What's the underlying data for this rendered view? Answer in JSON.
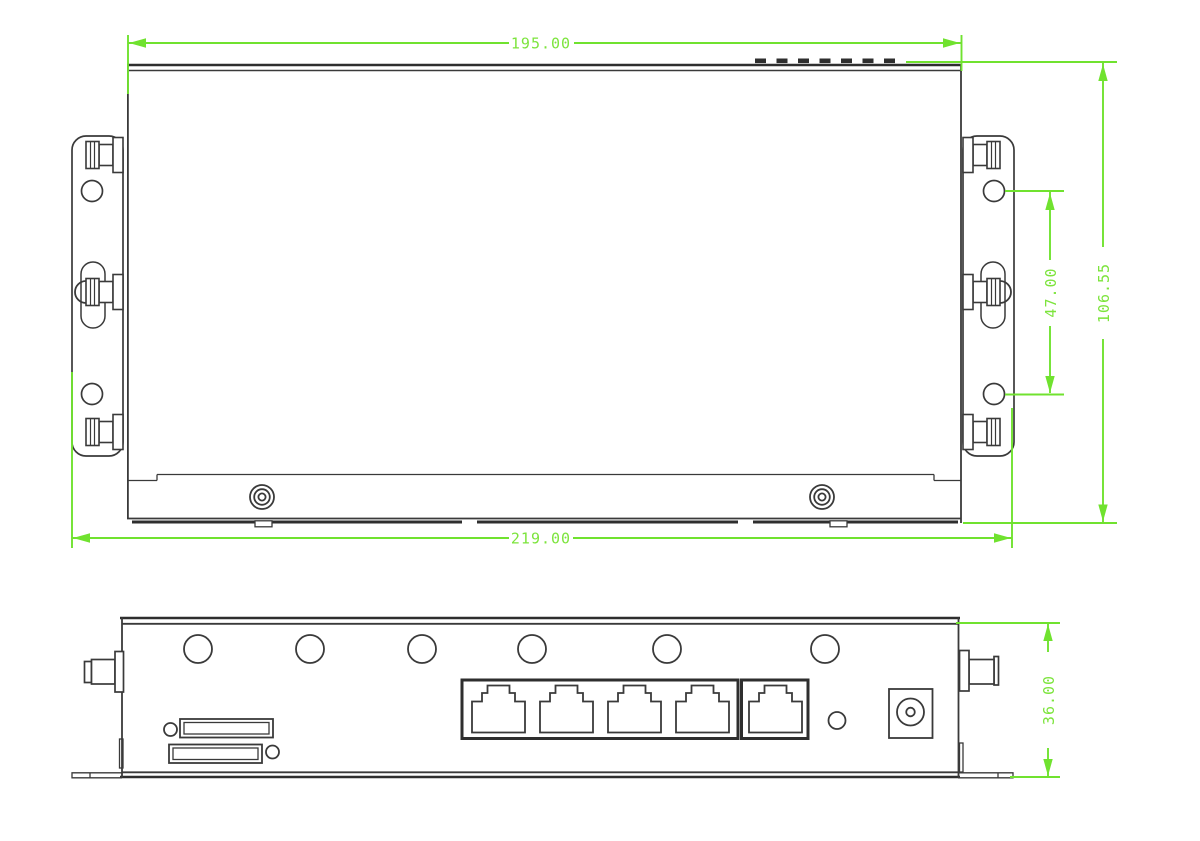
{
  "page": {
    "background": "#ffffff"
  },
  "colors": {
    "outline": "#3a3a3a",
    "dimension_green": "#70e22f"
  },
  "dimensions": {
    "body_width": "195.00",
    "overall_width": "219.00",
    "overall_depth": "106.55",
    "mount_hole_spacing": "47.00",
    "panel_height": "36.00"
  },
  "top_view": {
    "vent_slots": 7,
    "mounting_brackets": 2,
    "holes_per_bracket": 2,
    "screws_per_bracket": 3,
    "front_panel_screws": 2
  },
  "rear_view": {
    "round_holes": 6,
    "lan_ports": 4,
    "wan_ports": 1,
    "sim_card_slots": 2,
    "antenna_connectors": 2,
    "reset_buttons": 1,
    "dc_power_jacks": 1
  }
}
